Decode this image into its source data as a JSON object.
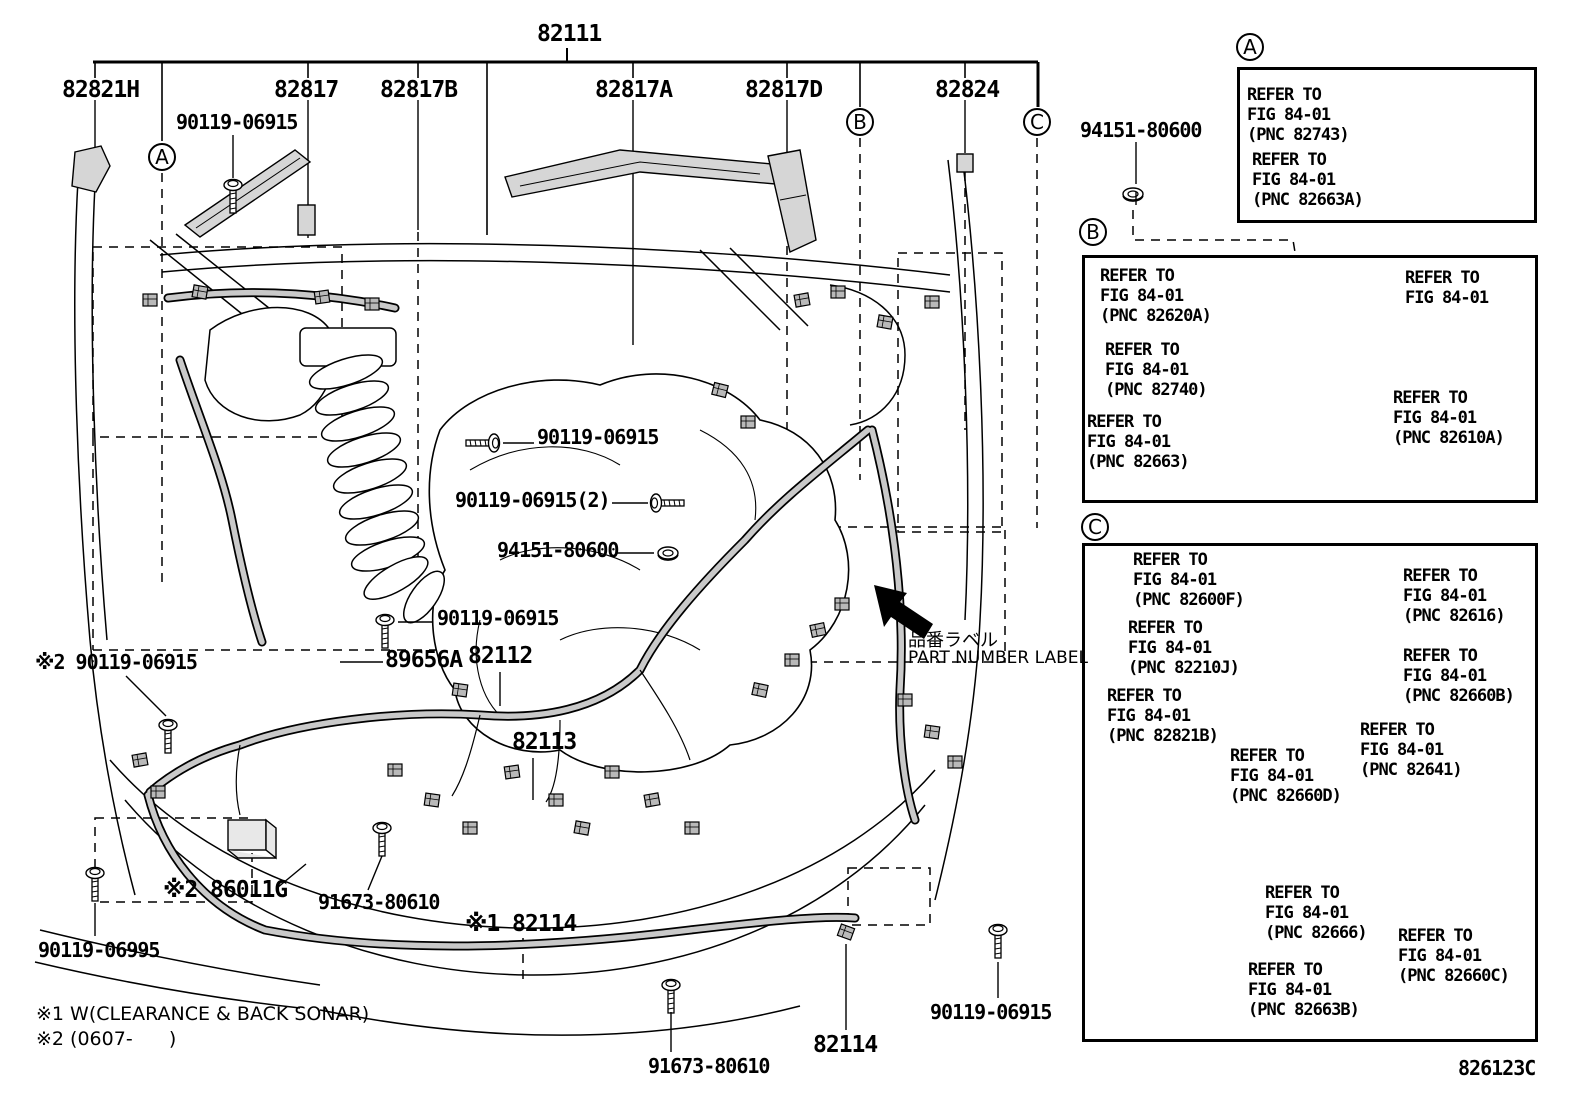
{
  "figure": {
    "code": "826123C"
  },
  "labels": {
    "l82111": "82111",
    "l82821h": "82821H",
    "l90119_tl": "90119-06915",
    "l82817": "82817",
    "l82817b": "82817B",
    "l82817a": "82817A",
    "l82817d": "82817D",
    "l82824": "82824",
    "l94151_tr": "94151-80600",
    "l90119_c1": "90119-06915",
    "l90119_c2": "90119-06915(2)",
    "l94151_c": "94151-80600",
    "l90119_c3": "90119-06915",
    "l90119_left": "※2 90119-06915",
    "l89656a": "89656A",
    "l82112": "82112",
    "l82113": "82113",
    "l86011g": "※2 86011G",
    "l91673_1": "91673-80610",
    "l82114_1": "※1 82114",
    "l90119_06995": "90119-06995",
    "l91673_2": "91673-80610",
    "l82114_2": "82114",
    "l90119_br": "90119-06915",
    "pn_label_jp": "品番ラベル",
    "pn_label_en": "PART NUMBER LABEL",
    "note1": "※1 W(CLEARANCE & BACK SONAR)",
    "note2": "※2 (0607-      )"
  },
  "callouts": {
    "main_a": "A",
    "main_b": "B",
    "main_c": "C",
    "panel_a": "A",
    "panel_b": "B",
    "panel_c": "C"
  },
  "panels": {
    "a": {
      "items": [
        "REFER TO\nFIG 84-01\n(PNC 82743)",
        "REFER TO\nFIG 84-01\n(PNC 82663A)"
      ]
    },
    "b": {
      "items": [
        "REFER TO\nFIG 84-01\n(PNC 82620A)",
        "REFER TO\nFIG 84-01",
        "REFER TO\nFIG 84-01\n(PNC 82740)",
        "REFER TO\nFIG 84-01\n(PNC 82610A)",
        "REFER TO\nFIG 84-01\n(PNC 82663)"
      ]
    },
    "c": {
      "items": [
        "REFER TO\nFIG 84-01\n(PNC 82600F)",
        "REFER TO\nFIG 84-01\n(PNC 82616)",
        "REFER TO\nFIG 84-01\n(PNC 82210J)",
        "REFER TO\nFIG 84-01\n(PNC 82660B)",
        "REFER TO\nFIG 84-01\n(PNC 82821B)",
        "REFER TO\nFIG 84-01\n(PNC 82641)",
        "REFER TO\nFIG 84-01\n(PNC 82660D)",
        "REFER TO\nFIG 84-01\n(PNC 82666)",
        "REFER TO\nFIG 84-01\n(PNC 82663B)",
        "REFER TO\nFIG 84-01\n(PNC 82660C)"
      ]
    }
  }
}
